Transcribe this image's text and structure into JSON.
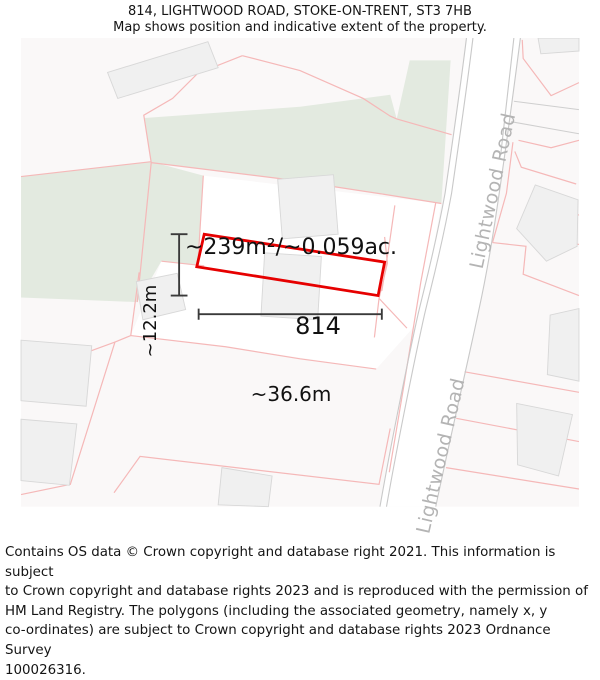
{
  "header": {
    "title": "814, LIGHTWOOD ROAD, STOKE-ON-TRENT, ST3 7HB",
    "subtitle": "Map shows position and indicative extent of the property."
  },
  "map": {
    "area_label": "~239m²/~0.059ac.",
    "plot_number": "814",
    "width_label": "~36.6m",
    "height_label": "~12.2m",
    "road_label_upper": "Lightwood Road",
    "road_label_lower": "Lightwood Road",
    "colors": {
      "highlight_red": "#e60000",
      "parcel_pink": "#f5b8b8",
      "green_area": "#e3eae0",
      "building_fill": "#f0f0f0",
      "building_stroke": "#d8d8d8",
      "road_line": "#c9c9c9",
      "road_text_gray": "#b4b4b4",
      "measure_gray": "#3a3a3a"
    }
  },
  "footer": {
    "lines": [
      "Contains OS data © Crown copyright and database right 2021. This information is subject",
      "to Crown copyright and database rights 2023 and is reproduced with the permission of",
      "HM Land Registry. The polygons (including the associated geometry, namely x, y",
      "co-ordinates) are subject to Crown copyright and database rights 2023 Ordnance Survey",
      "100026316."
    ]
  }
}
